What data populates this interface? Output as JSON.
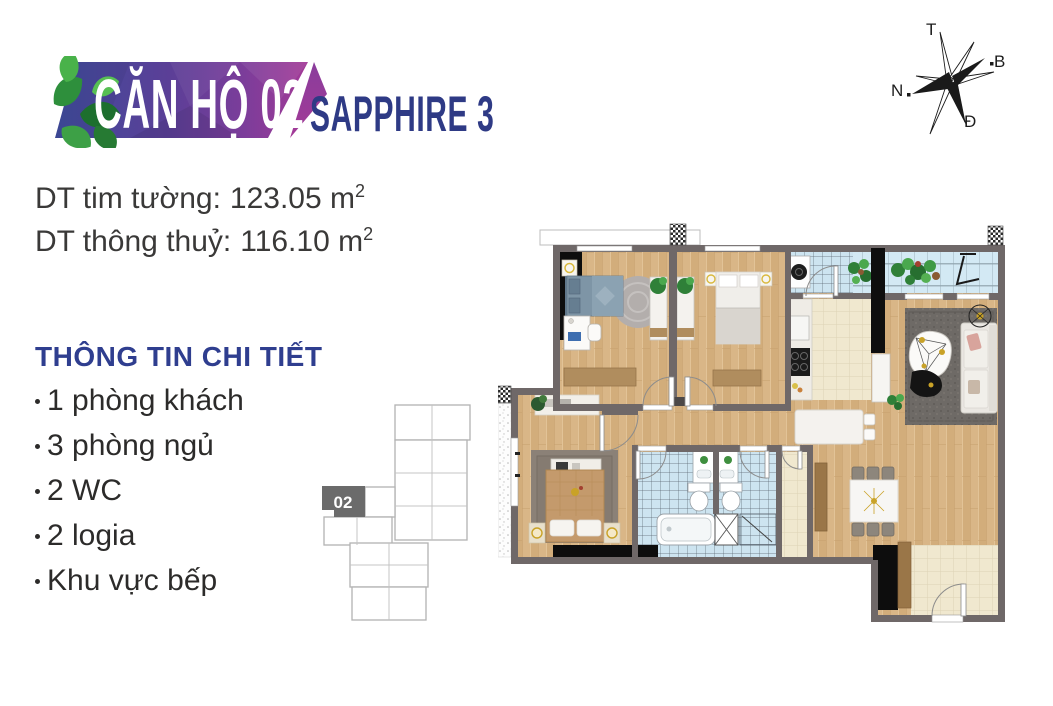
{
  "header": {
    "unit_title": "CĂN HỘ 02",
    "project_name": "SAPPHIRE 3"
  },
  "compass": {
    "labels": {
      "top": "T",
      "right": "B",
      "left": "N",
      "bottom": "Đ"
    }
  },
  "areas": {
    "lines": [
      {
        "label": "DT tim tường:",
        "value": "123.05 m",
        "sup": "2"
      },
      {
        "label": "DT thông thuỷ:",
        "value": "116.10 m",
        "sup": "2"
      }
    ]
  },
  "details": {
    "heading": "THÔNG TIN CHI TIẾT",
    "items": [
      "1 phòng khách",
      "3 phòng ngủ",
      "2 WC",
      "2 logia",
      "Khu vực bếp"
    ]
  },
  "minimap": {
    "unit_label": "02"
  },
  "colors": {
    "accent_navy": "#2f3e8f",
    "banner_blue": "#3f4b9b",
    "banner_purple": "#7c3d9a",
    "banner_magenta": "#a33a97",
    "leaf_green": "#2e8f3c",
    "wall_gray": "#6f6868",
    "wood_floor": "#d9b687",
    "bath_tile_blue": "#cde4f0",
    "tile_beige": "#f0e8cf",
    "text_dark": "#2c2b2a"
  }
}
